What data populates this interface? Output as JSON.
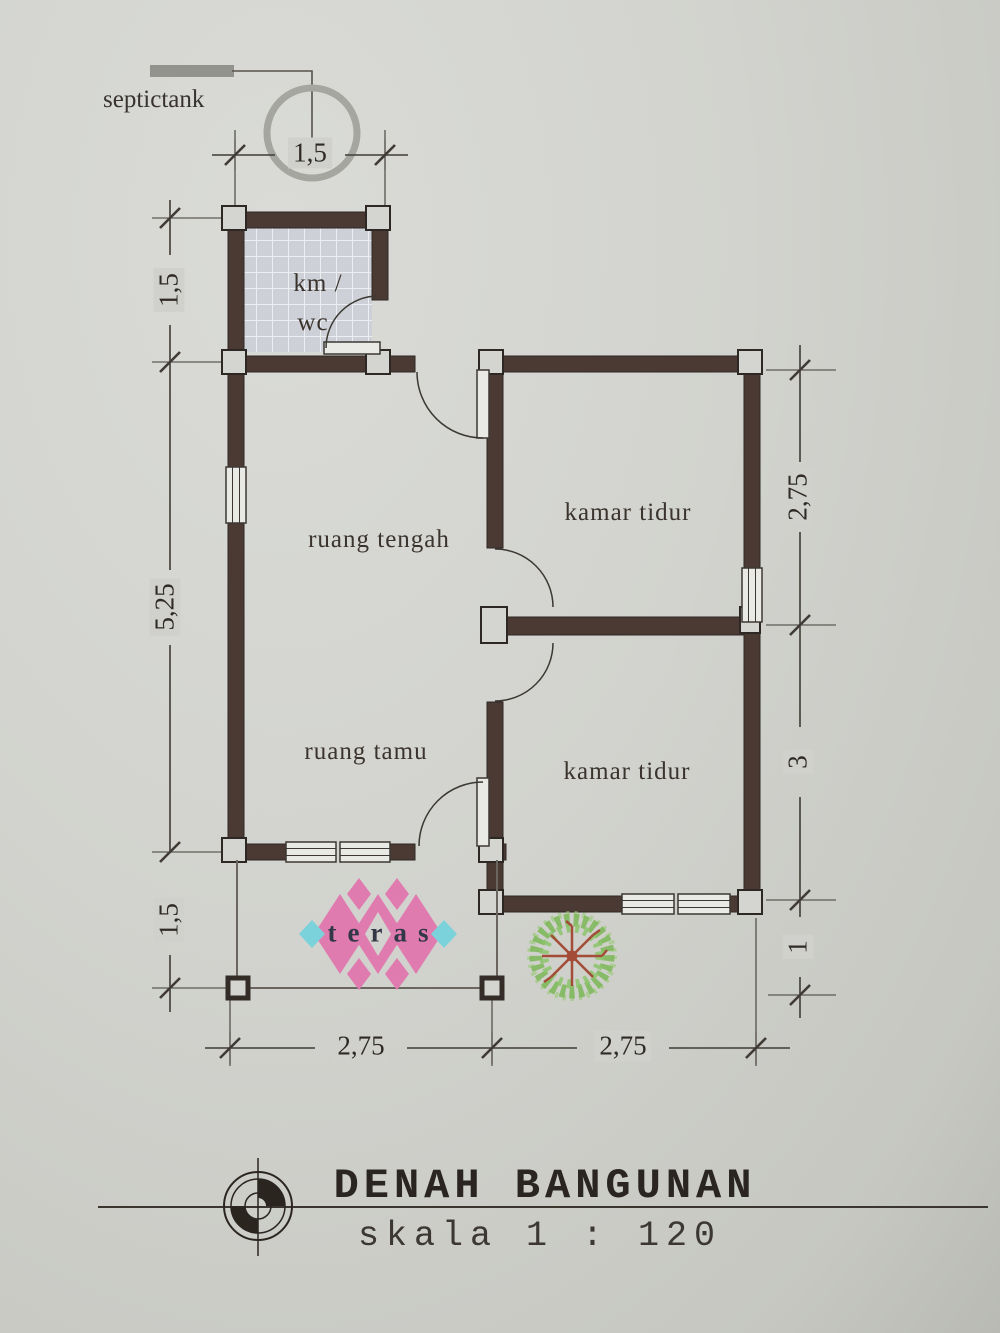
{
  "annotations": {
    "septictank": "septictank"
  },
  "rooms": {
    "km_wc_line1": "km /",
    "km_wc_line2": "wc",
    "ruang_tengah": "ruang tengah",
    "kamar_tidur_atas": "kamar tidur",
    "ruang_tamu": "ruang tamu",
    "kamar_tidur_bawah": "kamar tidur",
    "teras": "teras"
  },
  "dimensions": {
    "top": "1,5",
    "left": [
      "1,5",
      "5,25",
      "1,5"
    ],
    "right": [
      "2,75",
      "3",
      "1"
    ],
    "bottom": [
      "2,75",
      "2,75"
    ]
  },
  "title_block": {
    "title": "DENAH BANGUNAN",
    "scale": "skala 1 : 120"
  },
  "colors": {
    "paper": "#d2d3ce",
    "wall": "#4a3a33",
    "line": "#403b35",
    "tile": "#cdd1d7",
    "pattern_pink": "#e07bb0",
    "pattern_cyan": "#7cd2da",
    "tree_green": "#7fb85c",
    "tree_branch": "#a34c38",
    "septic_gray": "#a6a6a0"
  }
}
